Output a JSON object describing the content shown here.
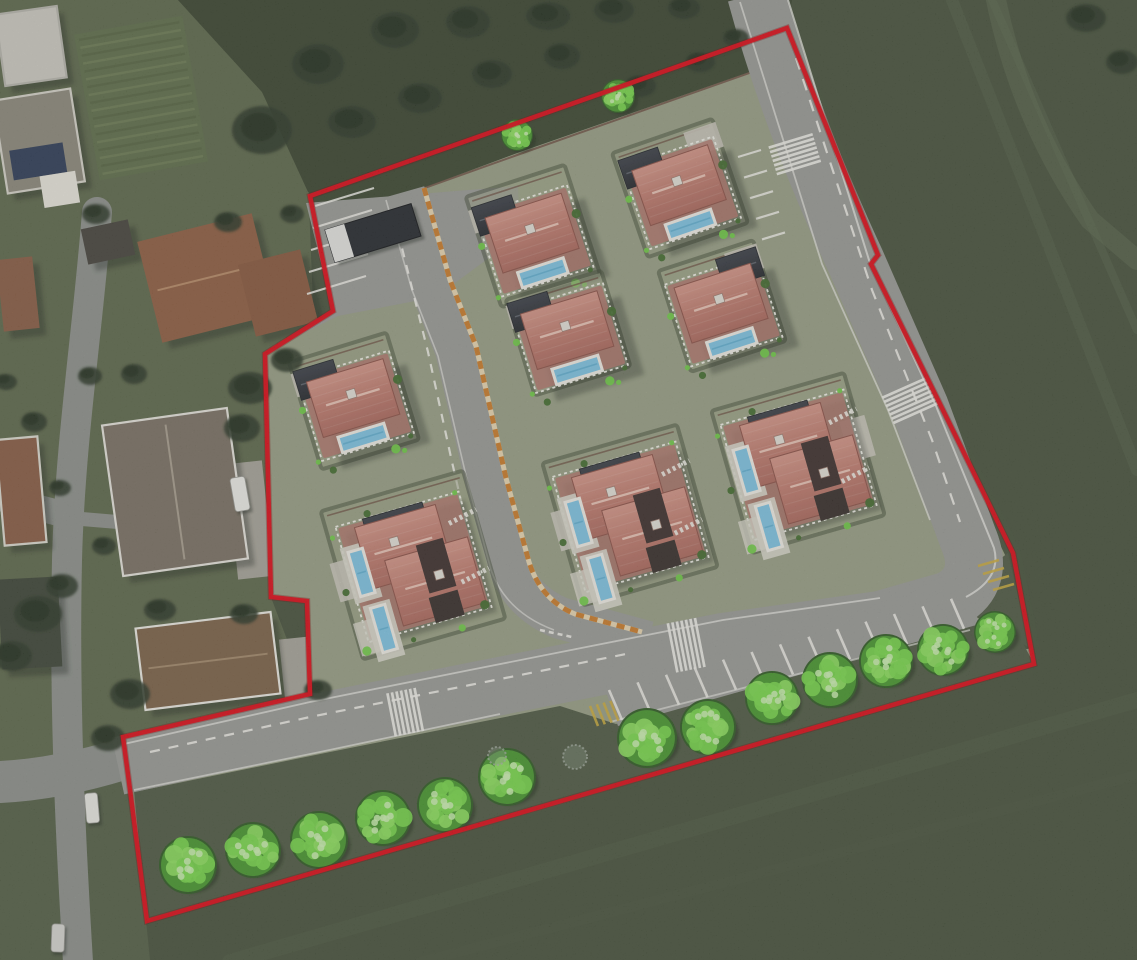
{
  "scene": {
    "width": 1137,
    "height": 960,
    "description": "aerial-site-plan-render"
  },
  "colors": {
    "boundary": "#e30613",
    "boundary_under": "#7a0000",
    "field": "#46513a",
    "scrub": "#39442e",
    "neigh_green": "#5d684a",
    "neigh_green2": "#535f45",
    "site_green": "#99a085",
    "hedge": "#3f4a33",
    "hedge_band": "#3a462f",
    "fence_brown": "#6a4a3c",
    "road": "#9a9b96",
    "street": "#8e928c",
    "kerb": "#e8e8e2",
    "marking": "#f2f1ea",
    "orange": "#cd7c28",
    "cream": "#ead9b2",
    "yellow": "#cfae3a",
    "roof_hi": "#d69687",
    "roof_mid": "#c17b6d",
    "roof_lo": "#ad685c",
    "roof_edge": "#8d5146",
    "ridge": "#edc9ba",
    "terrace": "#b3766b",
    "garage_hi": "#3a3e46",
    "garage_lo": "#23262b",
    "pool": "#7fc6e6",
    "pool_line": "#5aaed2",
    "pool_rim": "#f2f0e8",
    "deck": "#dcd9cd",
    "pad": "#ccc9bd",
    "tree_base": "#2e5a20",
    "tree_mid": "#46982c",
    "tree_spot": "#79da4a",
    "tree_light": "#cff2b4",
    "blob": "#2b3725",
    "shadow": "#161d15",
    "verge": "#4d5941",
    "trim": "#efeee6"
  },
  "boundary": {
    "stroke_width": 4.5,
    "points": [
      [
        310,
        196
      ],
      [
        787,
        28
      ],
      [
        878,
        255
      ],
      [
        871,
        264
      ],
      [
        939,
        402
      ],
      [
        1013,
        553
      ],
      [
        1034,
        664
      ],
      [
        147,
        921
      ],
      [
        129,
        782
      ],
      [
        123,
        737
      ],
      [
        310,
        694
      ],
      [
        307,
        601
      ],
      [
        271,
        597
      ],
      [
        265,
        354
      ],
      [
        333,
        311
      ]
    ]
  },
  "background": {
    "neighborhood_poly": [
      [
        0,
        0
      ],
      [
        178,
        0
      ],
      [
        262,
        92
      ],
      [
        308,
        178
      ],
      [
        315,
        356
      ],
      [
        268,
        414
      ],
      [
        272,
        600
      ],
      [
        310,
        700
      ],
      [
        128,
        740
      ],
      [
        0,
        772
      ]
    ],
    "neighborhood_poly2": [
      [
        0,
        772
      ],
      [
        128,
        740
      ],
      [
        150,
        960
      ],
      [
        0,
        960
      ]
    ],
    "top_scrub_poly": [
      [
        178,
        0
      ],
      [
        792,
        0
      ],
      [
        788,
        30
      ],
      [
        308,
        192
      ],
      [
        262,
        92
      ]
    ],
    "garden": {
      "x": 86,
      "y": 24,
      "w": 110,
      "h": 148,
      "rot": -10
    },
    "streaks": [
      {
        "d": "M 952,0 L 1137,470",
        "w": 12,
        "c": "#55624a",
        "o": 0.45
      },
      {
        "d": "M 992,0 L 1137,330",
        "w": 8,
        "c": "#5a684e",
        "o": 0.4
      },
      {
        "d": "M 230,962 L 1137,700",
        "w": 16,
        "c": "#4d5a41",
        "o": 0.5
      },
      {
        "d": "M 420,962 L 1137,775",
        "w": 10,
        "c": "#49553e",
        "o": 0.45
      },
      {
        "d": "M 995,-5 Q 1020,120 1090,220 L 1137,260",
        "w": 20,
        "c": "#5e6b50",
        "o": 0.5
      },
      {
        "d": "M 884,270 L 1005,555",
        "w": 10,
        "c": "#5a664b",
        "o": 0.4
      }
    ],
    "streets": [
      {
        "d": "M 97,212 C 88,330 70,440 67,560 C 64,700 70,830 78,962",
        "w": 30
      },
      {
        "d": "M 0,498 L 70,516",
        "w": 26
      },
      {
        "d": "M 0,782 C 40,780 82,772 126,758",
        "w": 42
      },
      {
        "d": "M 70,518 L 236,532",
        "w": 14
      }
    ],
    "pads": [
      {
        "x": 232,
        "y": 462,
        "w": 36,
        "h": 116,
        "rot": -6
      },
      {
        "x": 282,
        "y": 638,
        "w": 28,
        "h": 62,
        "rot": -6
      }
    ]
  },
  "site": {
    "apron": [
      [
        306,
        203
      ],
      [
        518,
        186
      ],
      [
        520,
        235
      ],
      [
        436,
        297
      ],
      [
        338,
        316
      ],
      [
        266,
        352
      ],
      [
        333,
        311
      ]
    ],
    "top_hedge": [
      [
        310,
        200
      ],
      [
        783,
        36
      ],
      [
        790,
        58
      ],
      [
        520,
        152
      ],
      [
        316,
        228
      ]
    ],
    "fence_line": "M 318,226 L 520,154 L 786,60",
    "underlay_top": {
      "d": "M 310,196 L 787,28",
      "w": 22,
      "c": "#39442e"
    },
    "underlay_right": {
      "d": "M 787,28 L 878,255 L 871,264 L 939,402 L 1013,553 L 1032,648",
      "w": 16,
      "c": "#46523a"
    },
    "verge": [
      [
        134,
        792
      ],
      [
        330,
        752
      ],
      [
        560,
        706
      ],
      [
        616,
        724
      ],
      [
        978,
        622
      ],
      [
        1000,
        600
      ],
      [
        1034,
        664
      ],
      [
        550,
        808
      ],
      [
        147,
        921
      ]
    ],
    "corner_grass": [
      [
        950,
        596
      ],
      [
        1008,
        553
      ],
      [
        1030,
        648
      ],
      [
        978,
        618
      ]
    ],
    "parking_fill": [
      [
        606,
        692
      ],
      [
        968,
        598
      ],
      [
        980,
        624
      ],
      [
        618,
        726
      ]
    ]
  },
  "roads": {
    "loop": {
      "d": "M 756,-6 Q 790,120 856,262 L 920,408 L 968,538 Q 986,580 950,600 L 880,620 L 723,642 L 470,692 L 310,724 L 118,766",
      "width": 58
    },
    "central": {
      "d": "M 404,192 L 430,284 L 456,350 L 486,480 L 509,566 Q 522,602 560,618 L 648,642",
      "width": 42
    },
    "orange": {
      "d": "M 424,188 L 450,280 L 476,346 L 506,478 L 529,562 Q 541,600 575,614 L 642,632"
    },
    "kerbs": [
      {
        "d": "M 124,744 L 310,702 L 470,670 L 723,620 L 880,598",
        "w": 1.8,
        "o": 0.75
      },
      {
        "d": "M 134,790 L 320,752 L 500,714",
        "w": 1.8,
        "o": 0.7
      },
      {
        "d": "M 610,722 L 970,630",
        "w": 1.8,
        "o": 0.65
      },
      {
        "d": "M 788,0 L 869,260 L 936,406 L 994,548 Q 1002,578 966,597",
        "w": 2,
        "o": 0.8
      },
      {
        "d": "M 740,2 L 822,264 L 888,410 L 930,520",
        "w": 1.8,
        "o": 0.7
      },
      {
        "d": "M 386,200 L 412,290 L 438,356 L 468,484 L 491,570 Q 506,612 554,630",
        "w": 1.6,
        "o": 0.65
      }
    ],
    "dashes": [
      {
        "d": "M 150,752 L 310,717 L 470,685 L 626,654",
        "da": "10 9",
        "w": 2.2
      },
      {
        "d": "M 796,58 L 872,290 L 932,440 L 960,522",
        "da": "12 10",
        "w": 2.2
      },
      {
        "d": "M 398,232 L 428,352 L 452,462 L 472,548",
        "da": "9 8",
        "w": 2.2
      },
      {
        "d": "M 540,630 L 572,637",
        "da": "5 4",
        "w": 2.6
      }
    ]
  },
  "markings": {
    "crosswalks": [
      {
        "x": 795,
        "y": 155,
        "dir": 73,
        "rw": 46
      },
      {
        "x": 911,
        "y": 401,
        "dir": 66,
        "rw": 50
      },
      {
        "x": 687,
        "y": 645,
        "dir": -11,
        "rw": 50
      },
      {
        "x": 406,
        "y": 712,
        "dir": -11,
        "rw": 44
      }
    ],
    "parking_bottom": {
      "x0": 622,
      "y0": 720,
      "dx": 28.5,
      "dy": -7.6,
      "n": 13,
      "vx": -13,
      "vy": -30
    },
    "perimeter_stalls": {
      "x0": 761,
      "y0": 150,
      "dx": 6,
      "dy": 20.6,
      "n": 5,
      "vx": -23,
      "vy": 7
    },
    "top_stalls": {
      "x0": 315,
      "y0": 206,
      "dx": -2,
      "dy": 22,
      "n": 5,
      "vx": 59,
      "vy": -18
    },
    "yellow_patch": {
      "x0": 598,
      "y0": 726,
      "dx": 6.8,
      "dy": -1.7,
      "n": 4,
      "vx": -8,
      "vy": -20
    },
    "corner_hatch": {
      "x0": 978,
      "y0": 566,
      "dx": 5,
      "dy": 8,
      "n": 4,
      "vx": 21,
      "vy": -6
    }
  },
  "buildings": [
    {
      "id": "house-white",
      "x": 0,
      "y": 10,
      "w": 62,
      "h": 72,
      "rot": -8,
      "fill": "#cfcdc3",
      "trim": "#b9b7ae"
    },
    {
      "id": "house-solar",
      "x": 0,
      "y": 94,
      "w": 78,
      "h": 94,
      "rot": -9,
      "fill": "#8d897b",
      "trim": "#d8d6cc",
      "extras": [
        {
          "x": 8,
          "y": 52,
          "w": 54,
          "h": 30,
          "fill": "#2c3a55"
        },
        {
          "x": 34,
          "y": 82,
          "w": 36,
          "h": 32,
          "fill": "#ece9e0"
        }
      ]
    },
    {
      "id": "shed",
      "x": 84,
      "y": 224,
      "w": 48,
      "h": 36,
      "rot": -12,
      "fill": "#45413a"
    },
    {
      "id": "house-terracotta",
      "x": 148,
      "y": 226,
      "w": 118,
      "h": 104,
      "rot": -14,
      "fill": "#8f5d3f",
      "ridge": "#b98b66"
    },
    {
      "id": "terracotta-wing",
      "x": 246,
      "y": 256,
      "w": 64,
      "h": 74,
      "rot": -14,
      "fill": "#89573b"
    },
    {
      "id": "house-left-a",
      "x": 0,
      "y": 258,
      "w": 36,
      "h": 72,
      "rot": -6,
      "fill": "#8a5c41"
    },
    {
      "id": "house-west-large",
      "x": 112,
      "y": 416,
      "w": 126,
      "h": 152,
      "rot": -8,
      "fill": "#7a7162",
      "trim": "#e9e7df",
      "ridge": "#a99f8e"
    },
    {
      "id": "house-left-b",
      "x": 0,
      "y": 438,
      "w": 42,
      "h": 106,
      "rot": -5,
      "fill": "#8a5c41",
      "trim": "#e0ddd2"
    },
    {
      "id": "building-left-dark",
      "x": 0,
      "y": 578,
      "w": 60,
      "h": 90,
      "rot": -3,
      "fill": "#3c4435"
    },
    {
      "id": "house-excluded",
      "x": 140,
      "y": 620,
      "w": 136,
      "h": 82,
      "rot": -7,
      "fill": "#7c6146",
      "trim": "#efeee6",
      "ridge": "#a3896a"
    }
  ],
  "vehicles": {
    "truck": {
      "cx": 373,
      "cy": 233,
      "rot": -17,
      "l": 90,
      "w": 34
    },
    "cars": [
      {
        "cx": 240,
        "cy": 494,
        "rot": -10,
        "l": 34,
        "w": 15,
        "fill": "#f0f0ea"
      },
      {
        "cx": 92,
        "cy": 808,
        "rot": -5,
        "l": 30,
        "w": 13,
        "fill": "#ecece6"
      },
      {
        "cx": 58,
        "cy": 938,
        "rot": 2,
        "l": 28,
        "w": 13,
        "fill": "#d8d8d2"
      }
    ]
  },
  "villas": [
    {
      "id": "villa-1",
      "type": "single",
      "cx": 533,
      "cy": 236,
      "rot": -18,
      "lw": 104,
      "lh": 116,
      "garage": "nw",
      "pad": "nw",
      "tint": "#a2a889"
    },
    {
      "id": "villa-2",
      "type": "single",
      "cx": 680,
      "cy": 188,
      "rot": -19,
      "lw": 106,
      "lh": 110,
      "garage": "nw",
      "pad": "ne",
      "tint": "#9aa183"
    },
    {
      "id": "villa-3",
      "type": "single",
      "cx": 722,
      "cy": 306,
      "rot": -18,
      "lw": 100,
      "lh": 106,
      "garage": "ne",
      "pad": "ne",
      "tint": "#a0a687"
    },
    {
      "id": "villa-4",
      "type": "single",
      "cx": 354,
      "cy": 401,
      "rot": -17,
      "lw": 102,
      "lh": 112,
      "garage": "nw",
      "pad": "nw",
      "tint": "#9ba282"
    },
    {
      "id": "villa-5",
      "type": "single",
      "cx": 568,
      "cy": 333,
      "rot": -17,
      "lw": 100,
      "lh": 100,
      "garage": "nw",
      "pad": "nw",
      "tint": "#a5ab8d"
    },
    {
      "id": "villa-6",
      "type": "duplex",
      "cx": 630,
      "cy": 515,
      "rot": -16,
      "lw": 140,
      "lh": 148,
      "pad": "w",
      "tint": "#9aa183"
    },
    {
      "id": "villa-7",
      "type": "duplex",
      "cx": 798,
      "cy": 463,
      "rot": -16,
      "lw": 138,
      "lh": 148,
      "pad": "e",
      "tint": "#a0a687"
    },
    {
      "id": "villa-8",
      "type": "duplex",
      "cx": 413,
      "cy": 565,
      "rot": -16,
      "lw": 148,
      "lh": 154,
      "pad": "w",
      "tint": "#9ca383"
    }
  ],
  "trees": {
    "bright": [
      {
        "x": 618,
        "y": 96,
        "r": 17
      },
      {
        "x": 517,
        "y": 135,
        "r": 16
      },
      {
        "x": 188,
        "y": 865,
        "r": 29
      },
      {
        "x": 253,
        "y": 850,
        "r": 28
      },
      {
        "x": 319,
        "y": 840,
        "r": 29
      },
      {
        "x": 383,
        "y": 818,
        "r": 28
      },
      {
        "x": 445,
        "y": 805,
        "r": 28
      },
      {
        "x": 507,
        "y": 777,
        "r": 29
      },
      {
        "x": 647,
        "y": 738,
        "r": 30
      },
      {
        "x": 708,
        "y": 727,
        "r": 28
      },
      {
        "x": 772,
        "y": 698,
        "r": 27
      },
      {
        "x": 830,
        "y": 680,
        "r": 28
      },
      {
        "x": 886,
        "y": 661,
        "r": 27
      },
      {
        "x": 943,
        "y": 650,
        "r": 26
      },
      {
        "x": 995,
        "y": 632,
        "r": 21
      }
    ],
    "faint": [
      {
        "x": 575,
        "y": 757,
        "r": 12
      },
      {
        "x": 497,
        "y": 756,
        "r": 9
      }
    ],
    "dark_blobs": [
      [
        262,
        130,
        30,
        24
      ],
      [
        318,
        64,
        26,
        20
      ],
      [
        395,
        30,
        24,
        18
      ],
      [
        468,
        22,
        22,
        16
      ],
      [
        548,
        16,
        22,
        14
      ],
      [
        614,
        10,
        20,
        13
      ],
      [
        684,
        8,
        16,
        11
      ],
      [
        736,
        38,
        13,
        9
      ],
      [
        352,
        122,
        24,
        16
      ],
      [
        420,
        98,
        22,
        15
      ],
      [
        492,
        74,
        20,
        14
      ],
      [
        562,
        56,
        18,
        13
      ],
      [
        640,
        86,
        16,
        11
      ],
      [
        700,
        62,
        15,
        10
      ],
      [
        250,
        388,
        22,
        16
      ],
      [
        242,
        428,
        18,
        14
      ],
      [
        287,
        360,
        16,
        12
      ],
      [
        96,
        214,
        14,
        10
      ],
      [
        228,
        222,
        14,
        10
      ],
      [
        292,
        214,
        12,
        9
      ],
      [
        134,
        374,
        13,
        10
      ],
      [
        90,
        376,
        12,
        9
      ],
      [
        34,
        422,
        13,
        10
      ],
      [
        6,
        382,
        11,
        8
      ],
      [
        38,
        614,
        24,
        18
      ],
      [
        12,
        656,
        20,
        15
      ],
      [
        62,
        586,
        16,
        12
      ],
      [
        104,
        546,
        12,
        9
      ],
      [
        130,
        694,
        20,
        15
      ],
      [
        108,
        738,
        17,
        13
      ],
      [
        160,
        610,
        16,
        11
      ],
      [
        244,
        614,
        14,
        10
      ],
      [
        318,
        690,
        14,
        10
      ],
      [
        1086,
        18,
        20,
        14
      ],
      [
        1122,
        62,
        16,
        12
      ],
      [
        60,
        488,
        11,
        8
      ]
    ]
  }
}
